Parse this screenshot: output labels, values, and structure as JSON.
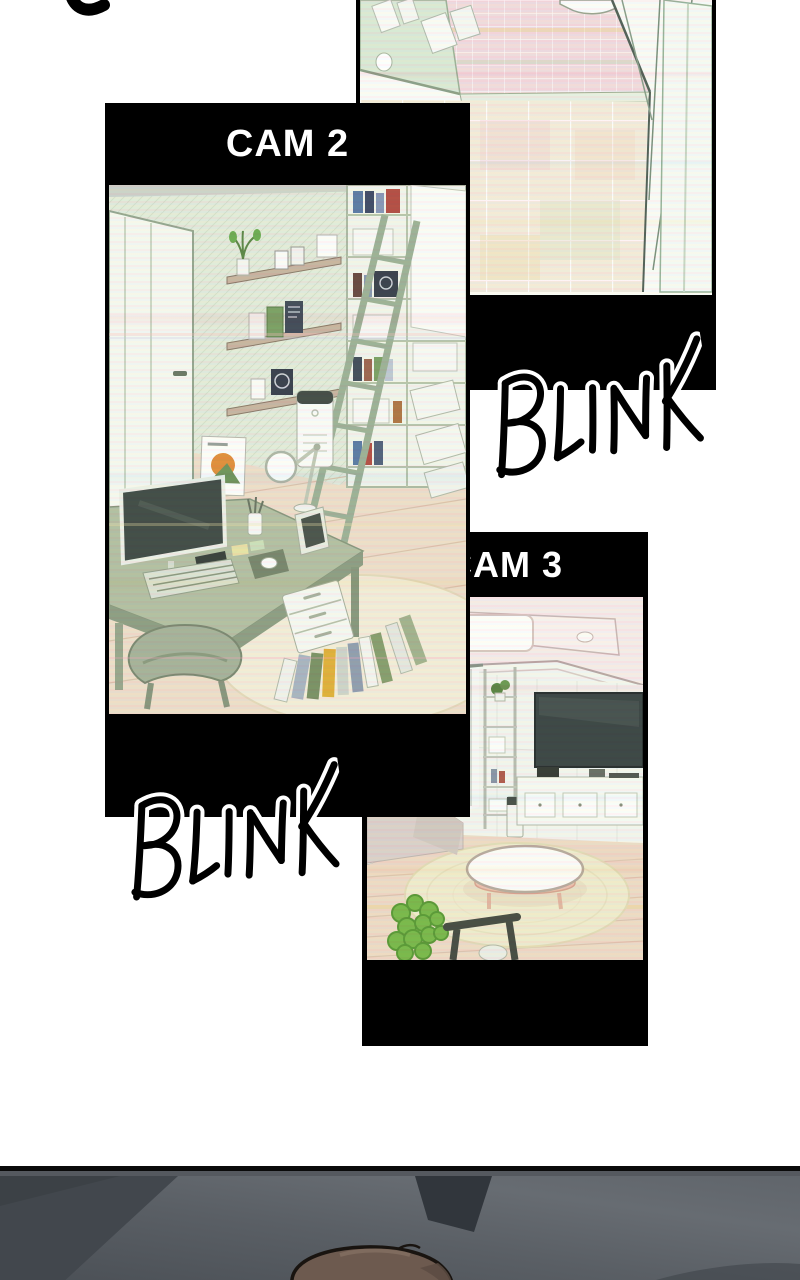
{
  "page": {
    "background": "#ffffff"
  },
  "cameras": {
    "hallway_cam": {
      "scene": "bathroom-entrance-tiled-floor"
    },
    "cam2": {
      "label": "CAM 2",
      "scene": "home-office-desk-and-bookshelf"
    },
    "cam3": {
      "label": "CAM 3",
      "scene": "living-room-sofa-table-tv"
    }
  },
  "sfx": {
    "blink_right": "BLINK",
    "blink_left": "BLINK"
  },
  "colors": {
    "panel_frame": "#000000",
    "cam_label_text": "#ffffff",
    "sfx_ink": "#000000",
    "sfx_outline": "#ffffff",
    "pastel_wall_green": "#e4ecdc",
    "pastel_tile_pink": "#f2dcdf",
    "wood_floor": "#eedcc8",
    "plant_green": "#7cba4e",
    "car_interior_gray": "#5d6268",
    "hair_brown": "#6d5a4f"
  }
}
